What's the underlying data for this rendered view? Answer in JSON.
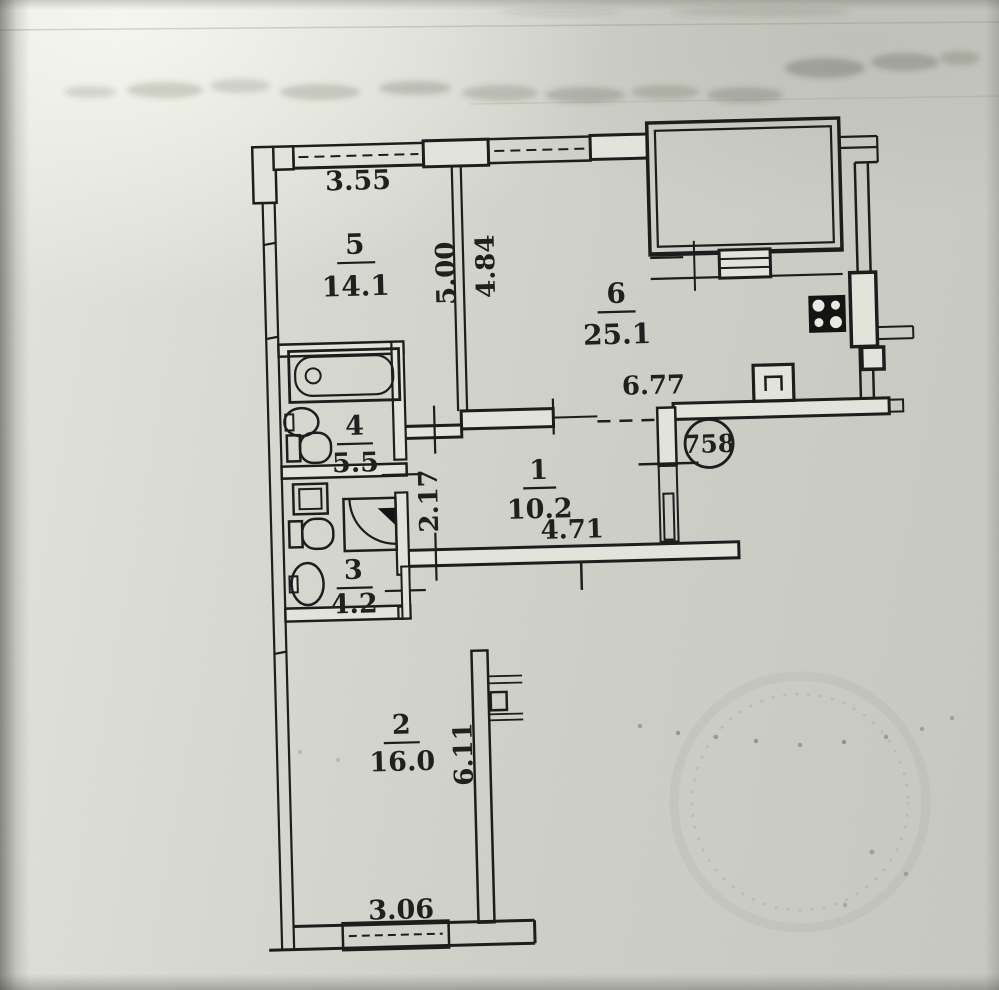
{
  "floor_plan": {
    "apartment_number": "758",
    "rooms": {
      "r1": {
        "number": "1",
        "area": "10.2"
      },
      "r2": {
        "number": "2",
        "area": "16.0"
      },
      "r3": {
        "number": "3",
        "area": "4.2"
      },
      "r4": {
        "number": "4",
        "area": "5.5"
      },
      "r5": {
        "number": "5",
        "area": "14.1"
      },
      "r6": {
        "number": "6",
        "area": "25.1"
      }
    },
    "dimensions": {
      "d355": "3.55",
      "d500": "5.00",
      "d484": "4.84",
      "d677": "6.77",
      "d217": "2.17",
      "d471": "4.71",
      "d611": "6.11",
      "d306": "3.06"
    },
    "fixtures": {
      "bathtub": "bathtub",
      "washbasin": "washbasin",
      "toilet_room4": "toilet",
      "toilet_room3": "toilet",
      "shower": "shower-tray",
      "washing_machine": "washing-machine",
      "hand_sink": "hand-sink",
      "kitchen_sink": "kitchen-sink",
      "stove": "stove-4-burner",
      "counter": "kitchen-counter",
      "radiator": "radiator"
    },
    "colors": {
      "paper": "#d4d5cd",
      "ink": "#1d1d1d"
    }
  }
}
